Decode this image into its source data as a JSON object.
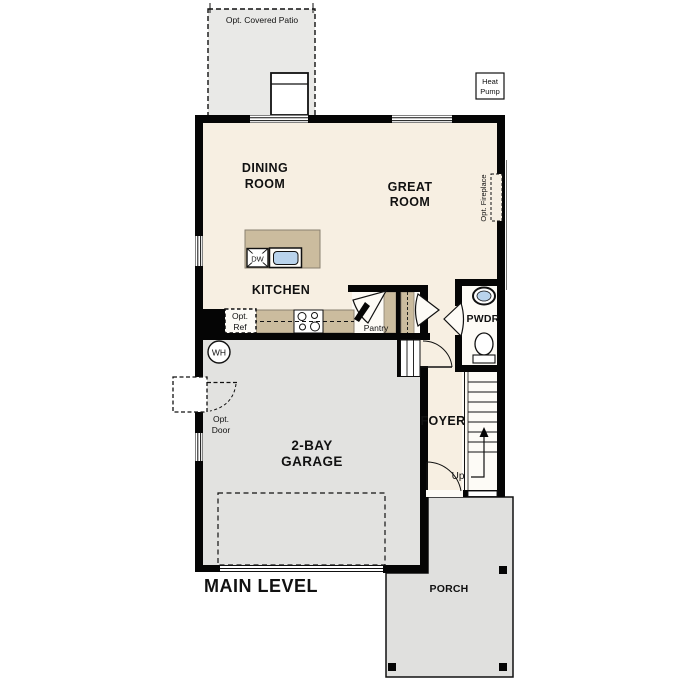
{
  "plan": {
    "level_title": "MAIN LEVEL",
    "rooms": {
      "dining_line1": "DINING",
      "dining_line2": "ROOM",
      "great_line1": "GREAT",
      "great_line2": "ROOM",
      "kitchen": "KITCHEN",
      "garage_line1": "2-BAY",
      "garage_line2": "GARAGE",
      "foyer": "FOYER",
      "pwdr": "PWDR",
      "porch": "PORCH",
      "pantry": "Pantry"
    },
    "options": {
      "covered_patio": "Opt. Covered Patio",
      "fireplace": "Opt. Fireplace",
      "ref_line1": "Opt.",
      "ref_line2": "Ref",
      "door_line1": "Opt.",
      "door_line2": "Door",
      "heat_pump_line1": "Heat",
      "heat_pump_line2": "Pump"
    },
    "fixtures": {
      "dishwasher": "DW",
      "water_heater": "WH",
      "stairs_direction": "Up"
    },
    "colors": {
      "wall": "#050505",
      "interior_cream": "#f7efe2",
      "concrete_gray": "#e2e2e0",
      "patio_gray": "#e9e9e7",
      "cabinet_tan": "#cbbc9e",
      "sink_blue": "#b9d3ec",
      "white": "#ffffff",
      "text": "#111111"
    }
  }
}
